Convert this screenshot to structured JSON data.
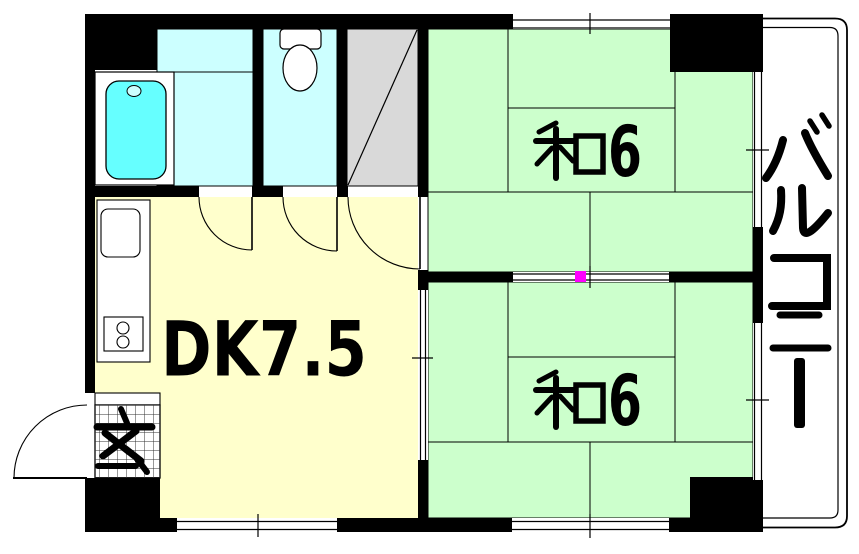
{
  "floor_plan": {
    "title": "2DK apartment floor plan",
    "rooms": {
      "washitsu_upper": {
        "label": "和6",
        "kanji": "和",
        "size": "6"
      },
      "washitsu_lower": {
        "label": "和6",
        "kanji": "和",
        "size": "6"
      },
      "dining_kitchen": {
        "label": "DK7.5"
      },
      "genkan": {
        "label": "玄"
      },
      "balcony": {
        "label": "バルコニー",
        "chars": [
          "バ",
          "ル",
          "コ",
          "ニ",
          "ー"
        ]
      },
      "bathroom": {
        "label": ""
      },
      "toilet": {
        "label": ""
      },
      "closet": {
        "label": ""
      }
    },
    "colors": {
      "tatami_green": "#ccffcc",
      "dk_yellow": "#ffffcc",
      "water_cyan": "#ccffff",
      "bathtub_cyan": "#66ffff",
      "closet_gray": "#d9d9d9",
      "wall_black": "#000000",
      "marker_magenta": "#ff00ff",
      "background": "#ffffff"
    }
  }
}
